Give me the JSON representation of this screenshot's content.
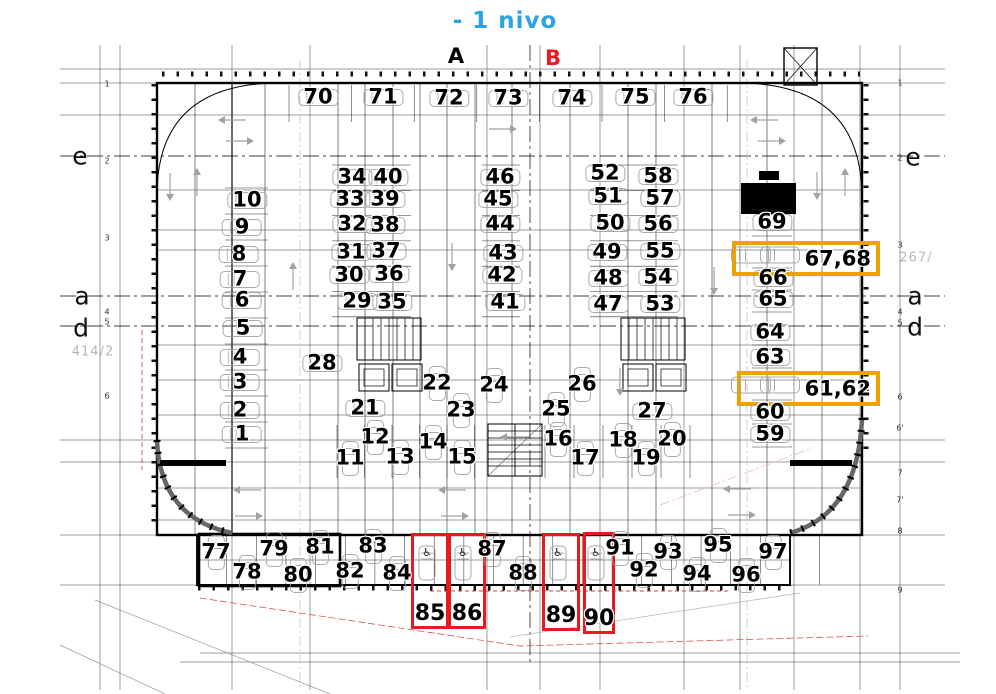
{
  "title": "- 1 nivo",
  "axis_markers": {
    "a": "A",
    "b": "B"
  },
  "grid_labels": {
    "left": [
      "e",
      "a",
      "d"
    ],
    "right": [
      "e",
      "a",
      "d"
    ]
  },
  "parcels": {
    "left": "414/2",
    "right": "267/"
  },
  "colors": {
    "accent_blue": "#29a3e2",
    "accent_red": "#e8191f",
    "accent_orange": "#f0a202",
    "car_gray": "#9c9c9c",
    "parcel_gray": "#b8b8b8"
  },
  "edge_numbers": {
    "left": [
      {
        "t": "1",
        "y": 84
      },
      {
        "t": "2",
        "y": 161
      },
      {
        "t": "3",
        "y": 238
      },
      {
        "t": "4",
        "y": 312
      },
      {
        "t": "5",
        "y": 322
      },
      {
        "t": "6",
        "y": 396
      }
    ],
    "right": [
      {
        "t": "1",
        "y": 83
      },
      {
        "t": "2",
        "y": 158
      },
      {
        "t": "3",
        "y": 245
      },
      {
        "t": "4",
        "y": 312
      },
      {
        "t": "5",
        "y": 323
      },
      {
        "t": "6",
        "y": 397
      },
      {
        "t": "6'",
        "y": 428
      },
      {
        "t": "7",
        "y": 473
      },
      {
        "t": "7'",
        "y": 500
      },
      {
        "t": "8",
        "y": 531
      },
      {
        "t": "9",
        "y": 590
      }
    ]
  },
  "spots": [
    {
      "n": "70",
      "x": 318,
      "y": 97,
      "o": "h"
    },
    {
      "n": "71",
      "x": 383,
      "y": 97,
      "o": "h"
    },
    {
      "n": "72",
      "x": 449,
      "y": 98,
      "o": "h"
    },
    {
      "n": "73",
      "x": 508,
      "y": 98,
      "o": "h"
    },
    {
      "n": "74",
      "x": 572,
      "y": 98,
      "o": "h"
    },
    {
      "n": "75",
      "x": 635,
      "y": 97,
      "o": "h"
    },
    {
      "n": "76",
      "x": 693,
      "y": 97,
      "o": "h"
    },
    {
      "n": "10",
      "x": 247,
      "y": 200,
      "o": "h"
    },
    {
      "n": "9",
      "x": 242,
      "y": 227,
      "o": "h"
    },
    {
      "n": "8",
      "x": 239,
      "y": 254,
      "o": "h"
    },
    {
      "n": "7",
      "x": 240,
      "y": 279,
      "o": "h"
    },
    {
      "n": "6",
      "x": 242,
      "y": 300,
      "o": "h"
    },
    {
      "n": "5",
      "x": 243,
      "y": 328,
      "o": "h"
    },
    {
      "n": "4",
      "x": 240,
      "y": 357,
      "o": "h"
    },
    {
      "n": "3",
      "x": 240,
      "y": 382,
      "o": "h"
    },
    {
      "n": "2",
      "x": 240,
      "y": 410,
      "o": "h"
    },
    {
      "n": "1",
      "x": 242,
      "y": 434,
      "o": "h"
    },
    {
      "n": "34",
      "x": 352,
      "y": 177,
      "o": "h"
    },
    {
      "n": "40",
      "x": 388,
      "y": 177,
      "o": "h"
    },
    {
      "n": "33",
      "x": 350,
      "y": 199,
      "o": "h"
    },
    {
      "n": "39",
      "x": 385,
      "y": 199,
      "o": "h"
    },
    {
      "n": "32",
      "x": 352,
      "y": 224,
      "o": "h"
    },
    {
      "n": "38",
      "x": 385,
      "y": 225,
      "o": "h"
    },
    {
      "n": "31",
      "x": 351,
      "y": 252,
      "o": "h"
    },
    {
      "n": "37",
      "x": 386,
      "y": 251,
      "o": "h"
    },
    {
      "n": "30",
      "x": 349,
      "y": 275,
      "o": "h"
    },
    {
      "n": "36",
      "x": 389,
      "y": 274,
      "o": "h"
    },
    {
      "n": "29",
      "x": 357,
      "y": 301,
      "o": "h"
    },
    {
      "n": "35",
      "x": 392,
      "y": 302,
      "o": "h"
    },
    {
      "n": "46",
      "x": 500,
      "y": 177,
      "o": "h"
    },
    {
      "n": "45",
      "x": 498,
      "y": 199,
      "o": "h"
    },
    {
      "n": "44",
      "x": 500,
      "y": 224,
      "o": "h"
    },
    {
      "n": "43",
      "x": 503,
      "y": 253,
      "o": "h"
    },
    {
      "n": "42",
      "x": 502,
      "y": 275,
      "o": "h"
    },
    {
      "n": "41",
      "x": 505,
      "y": 302,
      "o": "h"
    },
    {
      "n": "52",
      "x": 605,
      "y": 173,
      "o": "h"
    },
    {
      "n": "58",
      "x": 658,
      "y": 176,
      "o": "h"
    },
    {
      "n": "51",
      "x": 608,
      "y": 196,
      "o": "h"
    },
    {
      "n": "57",
      "x": 660,
      "y": 198,
      "o": "h"
    },
    {
      "n": "50",
      "x": 610,
      "y": 223,
      "o": "h"
    },
    {
      "n": "56",
      "x": 658,
      "y": 224,
      "o": "h"
    },
    {
      "n": "49",
      "x": 607,
      "y": 252,
      "o": "h"
    },
    {
      "n": "55",
      "x": 660,
      "y": 251,
      "o": "h"
    },
    {
      "n": "48",
      "x": 608,
      "y": 278,
      "o": "h"
    },
    {
      "n": "54",
      "x": 658,
      "y": 277,
      "o": "h"
    },
    {
      "n": "47",
      "x": 608,
      "y": 304,
      "o": "h"
    },
    {
      "n": "53",
      "x": 660,
      "y": 304,
      "o": "h"
    },
    {
      "n": "69",
      "x": 772,
      "y": 222,
      "o": "h"
    },
    {
      "n": "66",
      "x": 773,
      "y": 278,
      "o": "h"
    },
    {
      "n": "65",
      "x": 773,
      "y": 299,
      "o": "h"
    },
    {
      "n": "64",
      "x": 770,
      "y": 332,
      "o": "h"
    },
    {
      "n": "63",
      "x": 770,
      "y": 357,
      "o": "h"
    },
    {
      "n": "60",
      "x": 770,
      "y": 412,
      "o": "h"
    },
    {
      "n": "59",
      "x": 770,
      "y": 434,
      "o": "h"
    },
    {
      "n": "28",
      "x": 322,
      "y": 363,
      "o": "h"
    },
    {
      "n": "21",
      "x": 365,
      "y": 408,
      "o": "h"
    },
    {
      "n": "22",
      "x": 437,
      "y": 383,
      "o": "v"
    },
    {
      "n": "23",
      "x": 461,
      "y": 410,
      "o": "v"
    },
    {
      "n": "24",
      "x": 494,
      "y": 385,
      "o": "v"
    },
    {
      "n": "25",
      "x": 556,
      "y": 409,
      "o": "v"
    },
    {
      "n": "26",
      "x": 582,
      "y": 384,
      "o": "v"
    },
    {
      "n": "27",
      "x": 652,
      "y": 411,
      "o": "h"
    },
    {
      "n": "11",
      "x": 350,
      "y": 458,
      "o": "v"
    },
    {
      "n": "12",
      "x": 375,
      "y": 437,
      "o": "v"
    },
    {
      "n": "13",
      "x": 400,
      "y": 457,
      "o": "v"
    },
    {
      "n": "14",
      "x": 433,
      "y": 442,
      "o": "v"
    },
    {
      "n": "15",
      "x": 462,
      "y": 457,
      "o": "v"
    },
    {
      "n": "16",
      "x": 558,
      "y": 439,
      "o": "v"
    },
    {
      "n": "17",
      "x": 585,
      "y": 458,
      "o": "v"
    },
    {
      "n": "18",
      "x": 623,
      "y": 440,
      "o": "v"
    },
    {
      "n": "19",
      "x": 646,
      "y": 458,
      "o": "v"
    },
    {
      "n": "20",
      "x": 672,
      "y": 439,
      "o": "v"
    },
    {
      "n": "77",
      "x": 216,
      "y": 552,
      "o": "v"
    },
    {
      "n": "78",
      "x": 247,
      "y": 572,
      "o": "v"
    },
    {
      "n": "79",
      "x": 274,
      "y": 549,
      "o": "v"
    },
    {
      "n": "80",
      "x": 298,
      "y": 575,
      "o": "v"
    },
    {
      "n": "81",
      "x": 320,
      "y": 547,
      "o": "v"
    },
    {
      "n": "82",
      "x": 350,
      "y": 571,
      "o": "v"
    },
    {
      "n": "83",
      "x": 373,
      "y": 546,
      "o": "v"
    },
    {
      "n": "84",
      "x": 397,
      "y": 573,
      "o": "v"
    },
    {
      "n": "87",
      "x": 492,
      "y": 549,
      "o": "v"
    },
    {
      "n": "88",
      "x": 523,
      "y": 573,
      "o": "v"
    },
    {
      "n": "91",
      "x": 620,
      "y": 548,
      "o": "v"
    },
    {
      "n": "92",
      "x": 644,
      "y": 570,
      "o": "v"
    },
    {
      "n": "93",
      "x": 668,
      "y": 552,
      "o": "v"
    },
    {
      "n": "94",
      "x": 697,
      "y": 574,
      "o": "v"
    },
    {
      "n": "95",
      "x": 718,
      "y": 545,
      "o": "v"
    },
    {
      "n": "96",
      "x": 746,
      "y": 575,
      "o": "v"
    },
    {
      "n": "97",
      "x": 773,
      "y": 552,
      "o": "v"
    },
    {
      "n": "",
      "x": 427,
      "y": 563,
      "o": "v",
      "wc": true
    },
    {
      "n": "",
      "x": 463,
      "y": 563,
      "o": "v",
      "wc": true
    },
    {
      "n": "",
      "x": 558,
      "y": 563,
      "o": "v",
      "wc": true
    },
    {
      "n": "",
      "x": 596,
      "y": 563,
      "o": "v",
      "wc": true
    },
    {
      "n": "",
      "x": 751,
      "y": 255,
      "o": "h"
    },
    {
      "n": "",
      "x": 780,
      "y": 255,
      "o": "h"
    },
    {
      "n": "",
      "x": 751,
      "y": 385,
      "o": "h"
    },
    {
      "n": "",
      "x": 780,
      "y": 385,
      "o": "h"
    }
  ],
  "red_boxes": [
    {
      "label": "85",
      "x": 411,
      "y": 533,
      "w": 32,
      "h": 90
    },
    {
      "label": "86",
      "x": 448,
      "y": 533,
      "w": 32,
      "h": 90
    },
    {
      "label": "89",
      "x": 542,
      "y": 533,
      "w": 32,
      "h": 92
    },
    {
      "label": "90",
      "x": 583,
      "y": 532,
      "w": 26,
      "h": 96
    }
  ],
  "orange_boxes": [
    {
      "label": "67,68",
      "x": 732,
      "y": 241,
      "w": 140,
      "h": 27
    },
    {
      "label": "61,62",
      "x": 737,
      "y": 371,
      "w": 135,
      "h": 27
    }
  ]
}
